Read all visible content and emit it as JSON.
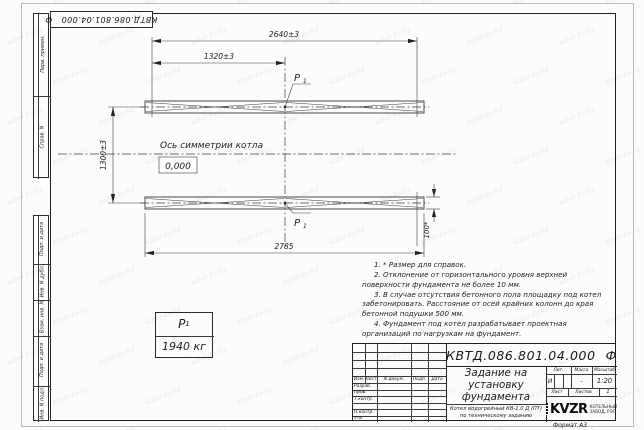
{
  "doc": {
    "number": "КВТД.086.801.04.000",
    "suffix": "Ф"
  },
  "watermark": {
    "text": "kotel-kv.kz"
  },
  "side": {
    "top": [
      "Перв. примен.",
      "Справ. N"
    ],
    "bottom": [
      "Подп. и дата",
      "Инв. N дубл.",
      "Взам. инв. N",
      "Подп. и дата",
      "Инв. N подл."
    ]
  },
  "drawing": {
    "dim_overall": "2640±3",
    "dim_half": "1320±3",
    "dim_height": "1300±3",
    "dim_length": "2785",
    "dim_rail": "100*",
    "axis_label": "Ось симметрии котла",
    "elevation": "0,000",
    "load_sym": "P",
    "load_sub": "1"
  },
  "load_table": {
    "sym": "P",
    "sub": "1",
    "value": "1940 кг"
  },
  "notes": [
    "1. * Размер для справок.",
    "2. Отклонение от горизонтального уровня верхней поверхности фундамента не более 10 мм.",
    "3. В случае отсутствия бетонного пола площадку под котел забетонировать. Расстояние от осей крайних колонн до края бетонной подушки 500 мм.",
    "4. Фундамент под котел разрабатывает проектная организаций по нагрузкам на фундамент."
  ],
  "title_block": {
    "header_cols": [
      "Изм.",
      "Лист",
      "N докум.",
      "Подп.",
      "Дата"
    ],
    "rows": [
      "Разраб.",
      "Пров.",
      "Т.контр.",
      "",
      "Н.контр.",
      "Утв."
    ],
    "title_lines": [
      "Задание на",
      "установку",
      "фундамента"
    ],
    "lit_headers": [
      "Лит.",
      "Масса",
      "Масштаб"
    ],
    "lit": "И",
    "mass": "-",
    "scale": "1:20",
    "sheet_label": "Лист",
    "sheets_label": "Листов",
    "sheets_value": "1",
    "product_lines": [
      "Котел водогрейный КВ-1,0 Д (ПТ)",
      "по техническому заданию"
    ],
    "logo_text": "KVZR",
    "logo_sub_lines": [
      "КОТЕЛЬНЫЙ",
      "ЗАВОД, РЭП"
    ],
    "format": "Формат А3"
  }
}
